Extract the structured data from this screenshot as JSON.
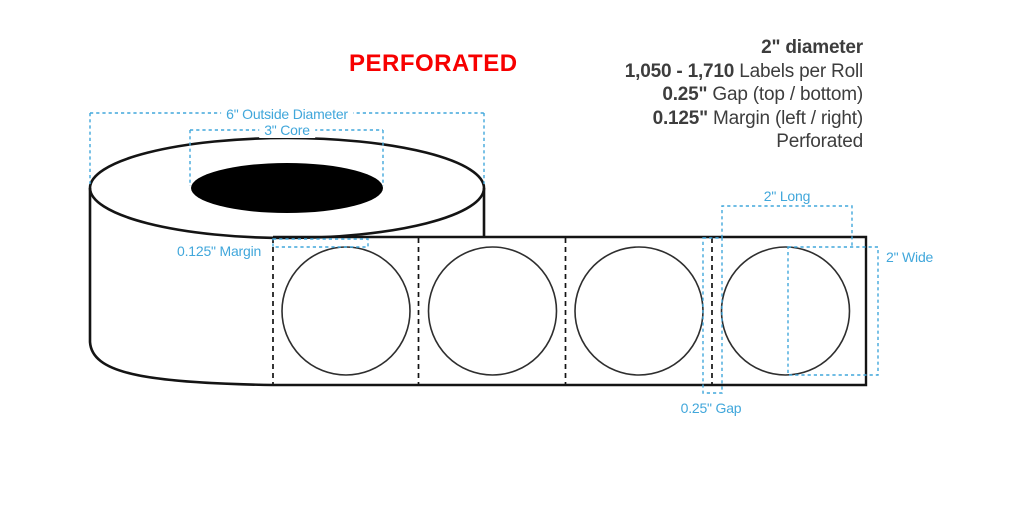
{
  "title": "PERFORATED",
  "specs": {
    "lines": [
      {
        "bold": "2\" diameter",
        "rest": ""
      },
      {
        "bold": "1,050 - 1,710",
        "rest": " Labels per Roll"
      },
      {
        "bold": "0.25\"",
        "rest": " Gap (top / bottom)"
      },
      {
        "bold": "0.125\"",
        "rest": " Margin (left / right)"
      },
      {
        "bold": "",
        "rest": "Perforated"
      }
    ]
  },
  "diagram": {
    "roll": {
      "outside_diameter": "6\" Outside Diameter",
      "core": "3\" Core"
    },
    "strip": {
      "margin": "0.125\" Margin",
      "length": "2\" Long",
      "width": "2\" Wide",
      "gap": "0.25\" Gap",
      "label_count": 4,
      "label_shape": "circle"
    }
  },
  "colors": {
    "accent-blue": "#41a7db",
    "alert-red": "#f70000",
    "text-dark": "#3d3d3d",
    "line-dark": "#141414"
  }
}
